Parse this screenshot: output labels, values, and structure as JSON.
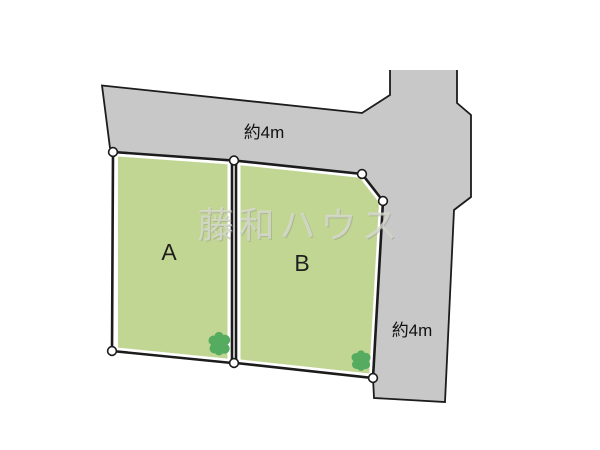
{
  "watermark": {
    "text": "藤和ハウス"
  },
  "lots": [
    {
      "id": "A",
      "label": "A"
    },
    {
      "id": "B",
      "label": "B"
    }
  ],
  "roads": {
    "top": {
      "width_label": "約4m"
    },
    "right": {
      "width_label": "約4m"
    }
  },
  "colors": {
    "background": "#ffffff",
    "road_fill": "#c8c8c8",
    "outline": "#1c1c1c",
    "lot_fill": "#c2d694",
    "lot_border_gap": "#ffffff",
    "tree_fill": "#55ab5f",
    "marker_fill": "#ffffff",
    "label_color": "#1f1f1f",
    "watermark_color": "#d9dad1"
  }
}
